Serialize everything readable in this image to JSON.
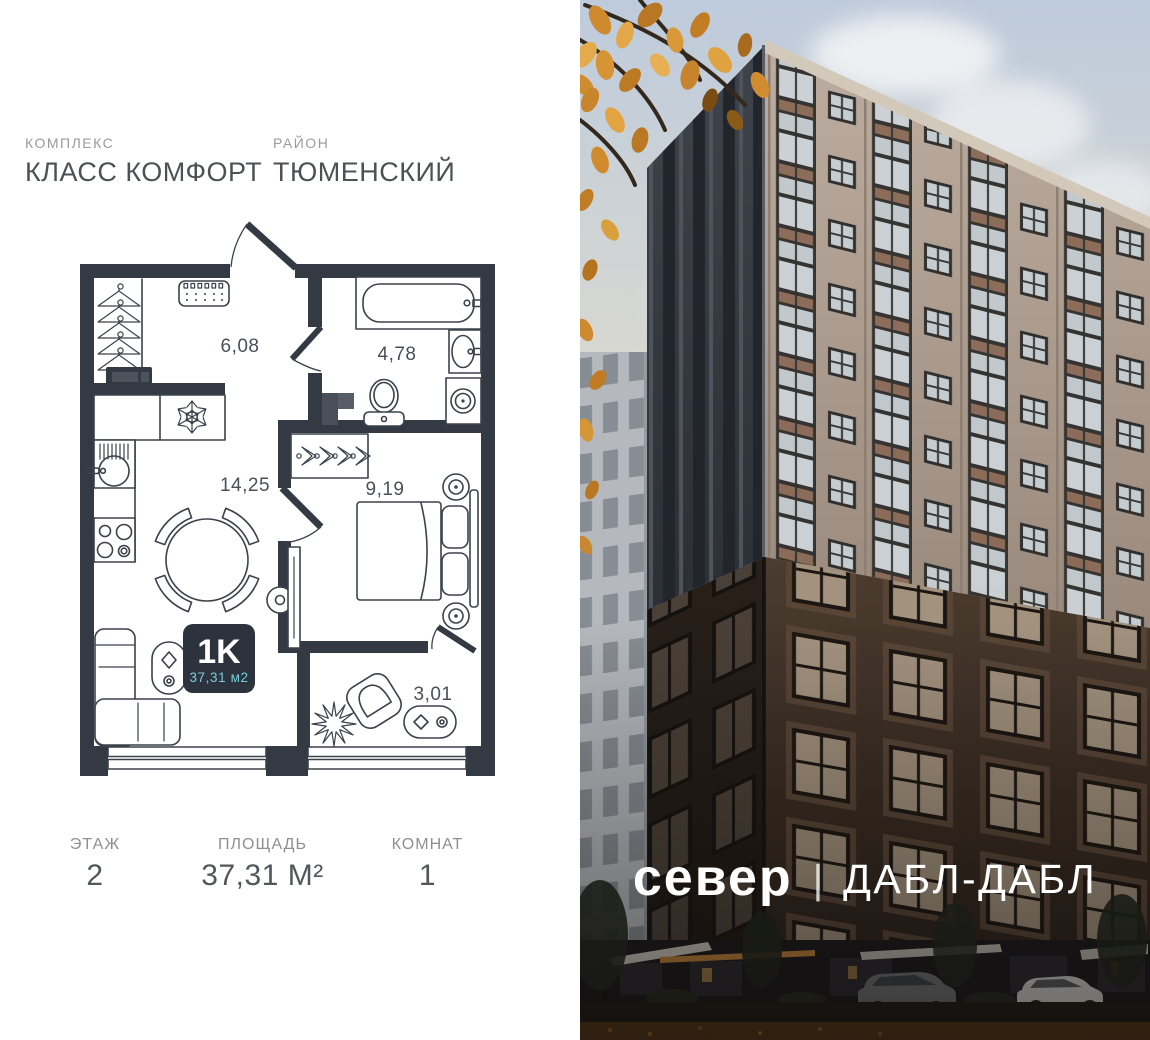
{
  "header": {
    "complex_label": "КОМПЛЕКС",
    "complex_value": "КЛАСС КОМФОРТ",
    "district_label": "РАЙОН",
    "district_value": "ТЮМЕНСКИЙ"
  },
  "plan": {
    "rooms": [
      {
        "name": "hallway",
        "area": "6,08"
      },
      {
        "name": "bathroom",
        "area": "4,78"
      },
      {
        "name": "kitchen-living",
        "area": "14,25"
      },
      {
        "name": "bedroom",
        "area": "9,19"
      },
      {
        "name": "balcony",
        "area": "3,01"
      }
    ],
    "badge": {
      "type": "1K",
      "area": "37,31 м2"
    }
  },
  "footer": {
    "floor_label": "ЭТАЖ",
    "floor_value": "2",
    "area_label": "ПЛОЩАДЬ",
    "area_value": "37,31 М²",
    "rooms_label": "КОМНАТ",
    "rooms_value": "1"
  },
  "logo": {
    "brand": "север",
    "separator": "|",
    "project": "ДАБЛ-ДАБЛ"
  },
  "colors": {
    "wall": "#333a44",
    "badge_bg": "#2c333d",
    "accent_cyan": "#79ccdf"
  }
}
